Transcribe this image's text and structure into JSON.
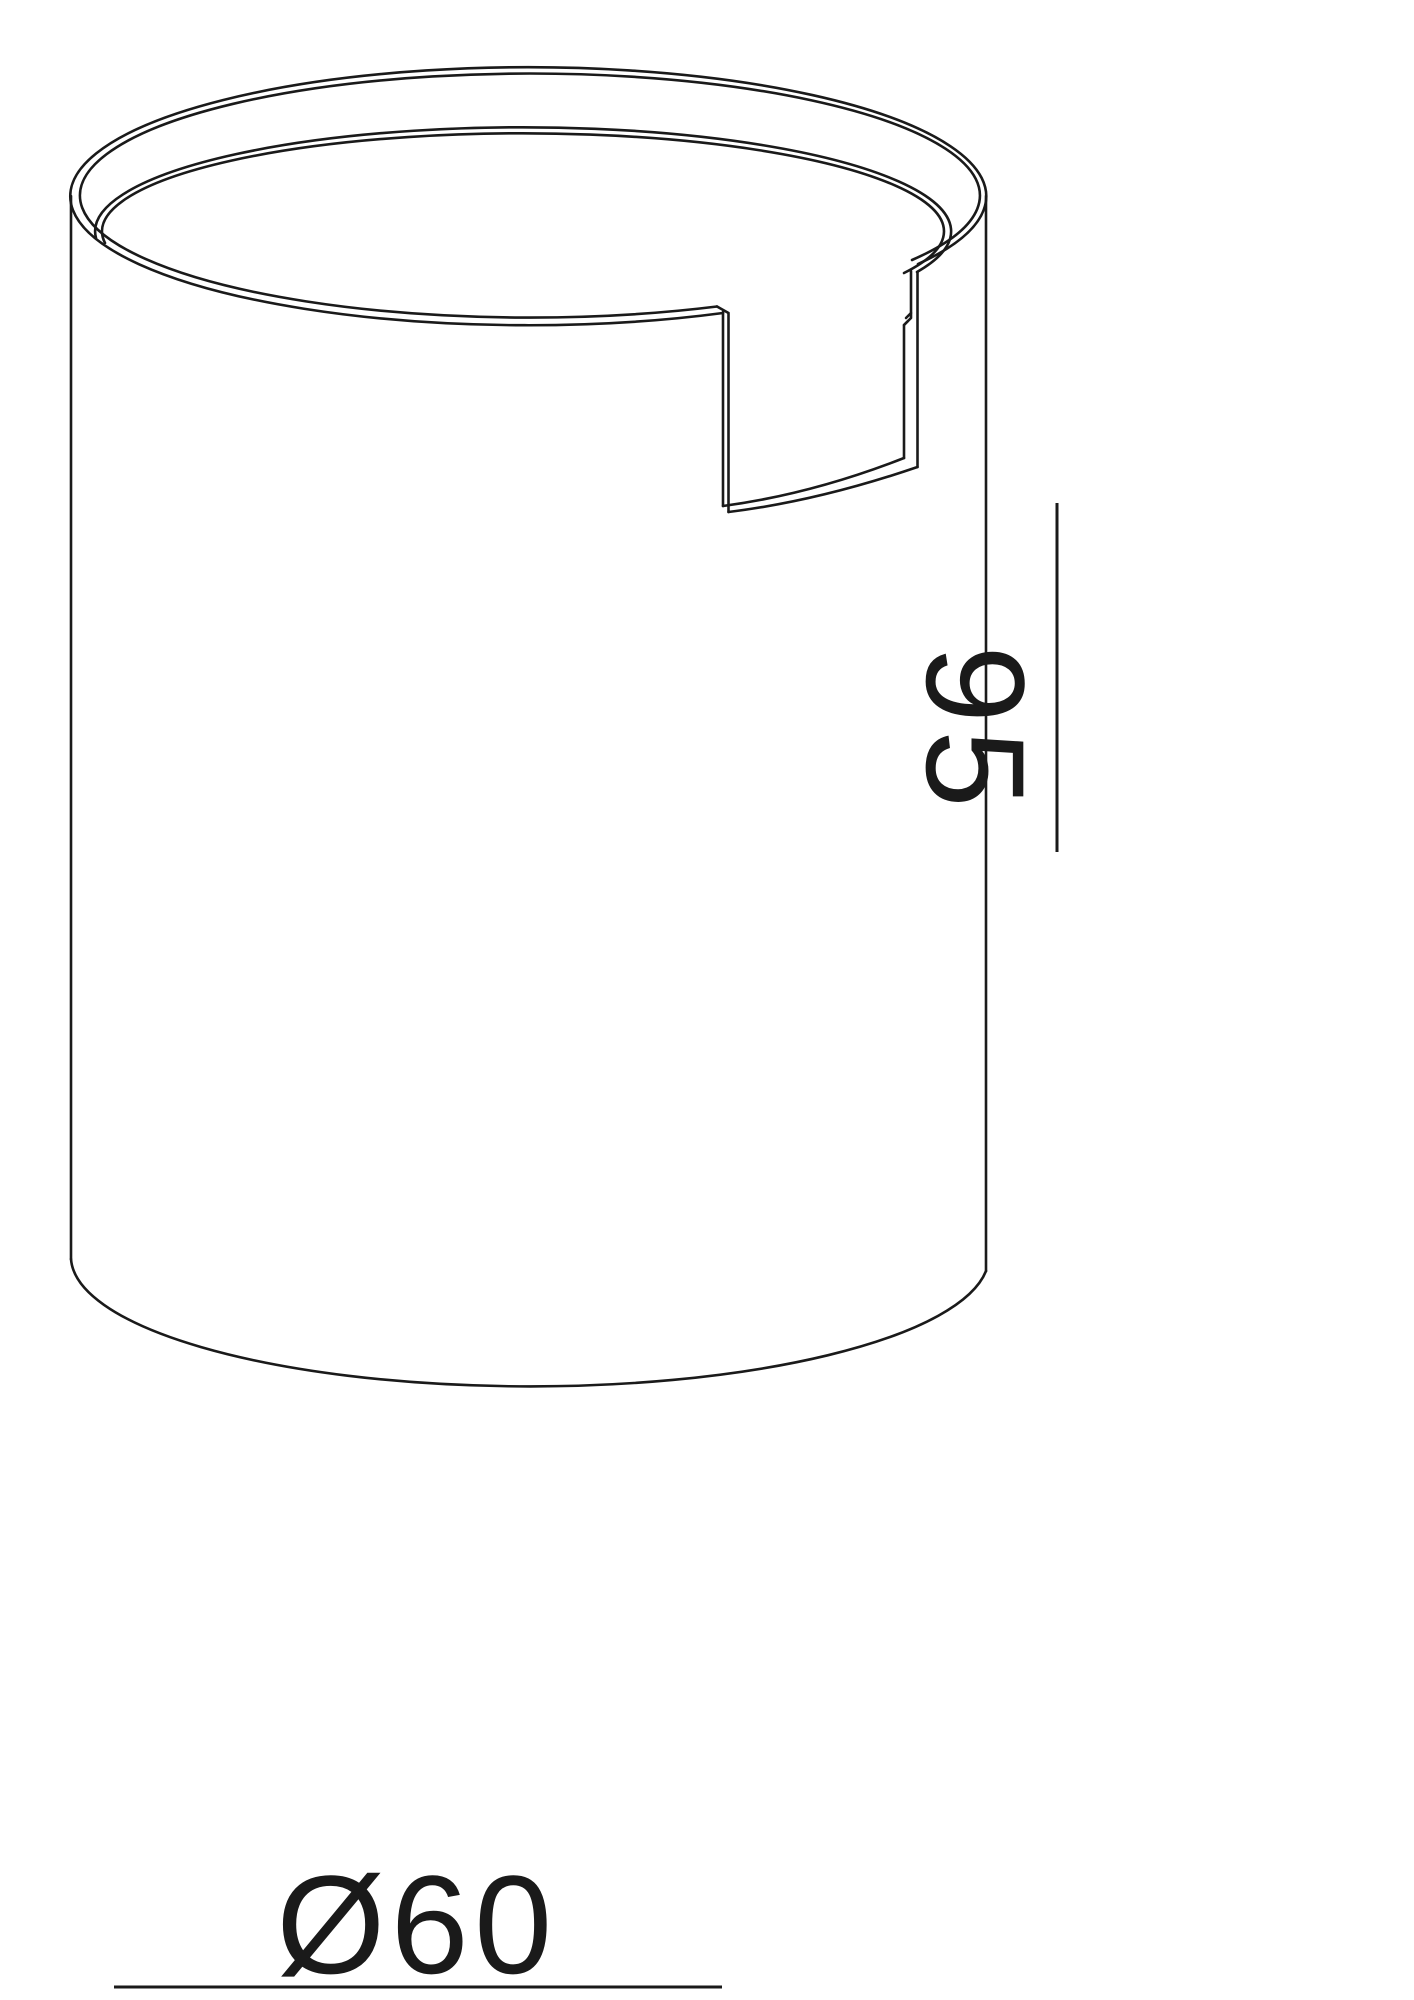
{
  "page": {
    "background_color": "#ffffff",
    "content_type": "technical line drawing of a cylindrical luminaire housing with a notch cut-out, shown in isometric view with dimension annotations"
  },
  "drawing": {
    "line_color": "#1a1a1a",
    "text_color": "#1a1a1a",
    "dimensions": {
      "height": {
        "label": "95",
        "orientation": "vertical",
        "line_side": "right"
      },
      "diameter": {
        "label": "Ø60",
        "orientation": "horizontal",
        "line_side": "bottom"
      }
    }
  }
}
